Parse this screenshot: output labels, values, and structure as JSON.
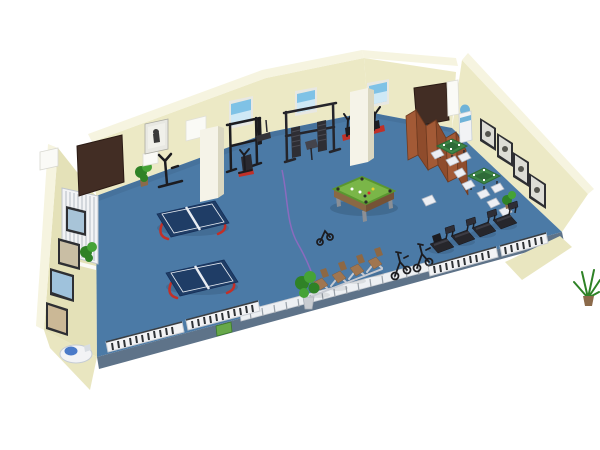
{
  "scene": {
    "type": "3d-floor-plan-render",
    "room_label": "Community activity and fitness room (isometric 3D rendering)"
  },
  "colors": {
    "floor": "#4B7AA6",
    "floorEdge": "#5E7389",
    "wall": "#ECE9C5",
    "wallLeft": "#E4E1B8",
    "wallTop": "#F6F4E0",
    "wallWedge": "#E9E6C0",
    "white": "#FAFAF6",
    "door": "#422D24",
    "doorFrame": "#2A1A14",
    "column": "#F5F3E8",
    "columnShade": "#D9D6C0",
    "divider": "#A35A36",
    "dividerDark": "#8F4C2C",
    "dividerEdge": "#6E3A20",
    "poolFelt": "#7AB648",
    "poolRim": "#5A9630",
    "poolWoodLight": "#8A6844",
    "poolWoodDark": "#755236",
    "pingpongTop": "#1F3D66",
    "pingpongLine": "#E8ECF2",
    "pingpongLeg": "#C23028",
    "mahjongTop": "#3E8647",
    "mahjongInner": "#2E6B38",
    "chairWhite": "#EDEFF4",
    "chairStroke": "#B8BEC8",
    "treadmill": "#26262B",
    "treadmillBelt": "#3C3C44",
    "console": "#2E2E36",
    "loungerSeat": "#A07650",
    "loungerBack": "#8D6844",
    "frameSilver": "#C6CAD2",
    "radiatorWhite": "#F2F3F5",
    "radiatorSlat": "#2E3236",
    "radiatorStroke": "#C9CDD3",
    "radiatorRib": "#D3D7DC",
    "railWhite": "#EDF0F3",
    "railPost": "#9AA2AA",
    "plantGreen": "#2F8226",
    "plantLight": "#45A336",
    "potBrown": "#8B6A4A",
    "potGray": "#C9CDD2",
    "cablePurple": "#8B6BBE",
    "skyPoster": "#7FC2E6",
    "skyPosterLight": "#CFE9F6",
    "pictureFrameDark": "#2E2F33",
    "pictureMat": "#DDDDD6",
    "pictureFrameLight": "#E8E8E2",
    "pictureBlob": "#55554F",
    "figureDark": "#3A3A3A",
    "picBlue": "#A8C4D8",
    "picTan": "#C9BEA4",
    "picSky": "#9FC2DC",
    "picSand": "#CBB896",
    "waterBlue": "#6FB3D8",
    "fountainBlue": "#4A7AC8",
    "equipmentBlack": "#1C1C20",
    "accentRed": "#C03028",
    "greenBox": "#67A84A"
  },
  "items": {
    "room": {
      "label": "Activity room 3D floor plan"
    },
    "floor": {
      "label": "Blue floor"
    },
    "back_wall": {
      "label": "Back wall"
    },
    "left_wall": {
      "label": "Left wall"
    },
    "right_wall": {
      "label": "Right wall"
    },
    "door_left": {
      "label": "Wooden door, back-left corner"
    },
    "door_right": {
      "label": "Wooden door, back-right"
    },
    "column_1": {
      "label": "Support column"
    },
    "column_2": {
      "label": "Support column"
    },
    "radiator_left": {
      "label": "Wall radiator"
    },
    "pictures_left": {
      "label": "Framed pictures on left wall"
    },
    "pictures_right": {
      "label": "Framed pictures on right wall"
    },
    "picture_back": {
      "label": "Framed picture on back wall"
    },
    "notice_board": {
      "label": "White notice board"
    },
    "small_sign": {
      "label": "Small wall sign"
    },
    "poster_sky_1": {
      "label": "Sky poster above pull-up frame"
    },
    "poster_sky_2": {
      "label": "Sky poster above gym machine"
    },
    "poster_sky_3": {
      "label": "Sky poster above exercise bikes"
    },
    "exercise_bikes": {
      "label": "Exercise bikes along back wall"
    },
    "pullup_station": {
      "label": "Pull-up station"
    },
    "multi_gym": {
      "label": "Multi-station gym machine"
    },
    "small_machine": {
      "label": "Small weight machine"
    },
    "divider_screen": {
      "label": "Folding wooden screen divider"
    },
    "cabinet": {
      "label": "White wall cabinet"
    },
    "water_cooler": {
      "label": "Water cooler"
    },
    "mahjong_area": {
      "label": "Mahjong tables with chairs"
    },
    "treadmills": {
      "label": "Row of treadmills"
    },
    "loungers": {
      "label": "Row of recliner exercise chairs"
    },
    "spin_bikes": {
      "label": "Spin bikes"
    },
    "railing": {
      "label": "White floor railing"
    },
    "radiators_front": {
      "label": "Baseboard radiator grilles"
    },
    "green_box": {
      "label": "Green floor unit"
    },
    "pingpong_tables": {
      "label": "Table tennis tables"
    },
    "pool_table": {
      "label": "Billiards table"
    },
    "cable": {
      "label": "Purple floor cable"
    },
    "plants": {
      "label": "Potted plants"
    },
    "fountain": {
      "label": "Drinking fountain"
    },
    "white_chair": {
      "label": "White chair"
    }
  }
}
